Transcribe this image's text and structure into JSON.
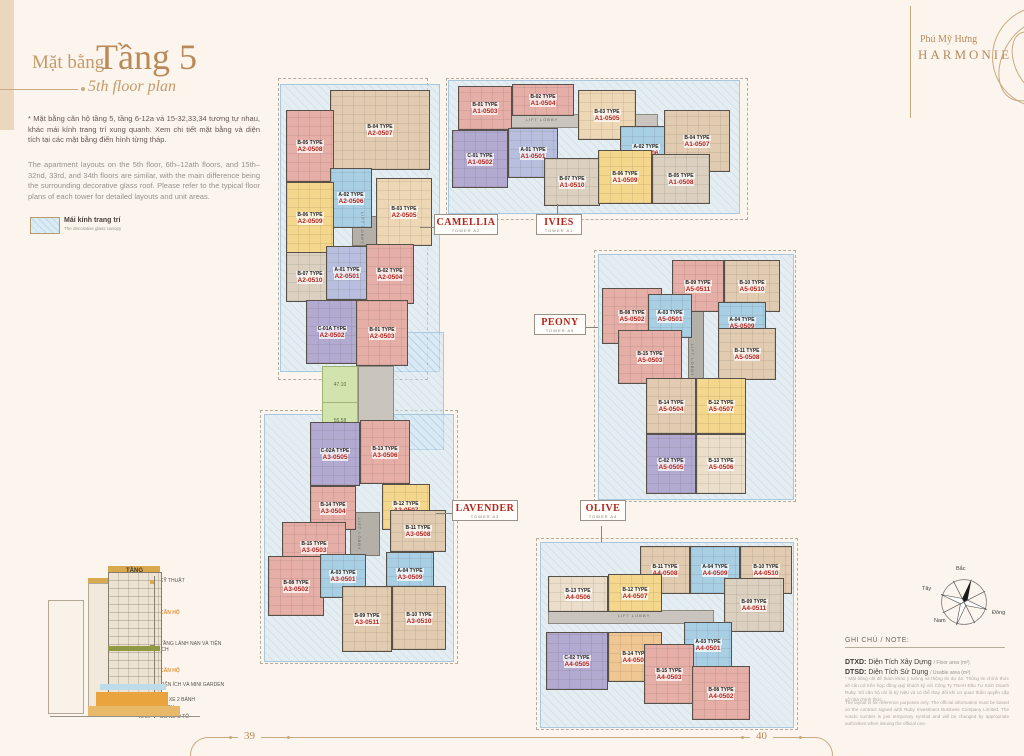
{
  "brand": {
    "line1": "Phú Mỹ Hưng",
    "line2": "HARMONIE"
  },
  "title": {
    "prefix": "Mặt bằng",
    "main": "Tầng 5",
    "sub": "5th floor plan"
  },
  "intro": {
    "vi": "* Mặt bằng căn hộ tầng 5, tầng 6-12a và 15-32,33,34 tương tự nhau, khác mái kính trang trí xung quanh. Xem chi tiết mặt bằng và diện tích tại các mặt bằng điển hình từng tháp.",
    "en": "The apartment layouts on the 5th floor, 6th–12ath floors, and 15th–32nd, 33rd, and 34th floors are similar, with the main difference being the surrounding decorative glass roof. Please refer to the typical floor plans of each tower for detailed layouts and unit areas."
  },
  "legend": {
    "vi": "Mái kính trang trí",
    "en": "The decorative glass canopy"
  },
  "plan": {
    "lift_lobby": "LIFT LOBBY",
    "green_areas": [
      "47.10",
      "55.58"
    ]
  },
  "towers": [
    {
      "name": "CAMELLIA",
      "tower": "TOWER A2",
      "units": [
        {
          "type": "B-04 TYPE",
          "code": "A2-0507",
          "color": "#e1cbb1"
        },
        {
          "type": "B-05 TYPE",
          "code": "A2-0508",
          "color": "#e5afa7"
        },
        {
          "type": "A-02 TYPE",
          "code": "A2-0506",
          "color": "#a8cfe4"
        },
        {
          "type": "B-06 TYPE",
          "code": "A2-0509",
          "color": "#f4d78c"
        },
        {
          "type": "B-03 TYPE",
          "code": "A2-0505",
          "color": "#edd7b5"
        },
        {
          "type": "B-07 TYPE",
          "code": "A2-0510",
          "color": "#dcd1c1"
        },
        {
          "type": "A-01 TYPE",
          "code": "A2-0501",
          "color": "#b8bede"
        },
        {
          "type": "B-02 TYPE",
          "code": "A2-0504",
          "color": "#e5afa7"
        },
        {
          "type": "C-01A TYPE",
          "code": "A2-0502",
          "color": "#b2aad1"
        },
        {
          "type": "B-01 TYPE",
          "code": "A2-0503",
          "color": "#e5afa7"
        }
      ]
    },
    {
      "name": "IVIES",
      "tower": "TOWER A1",
      "units": [
        {
          "type": "B-01 TYPE",
          "code": "A1-0503",
          "color": "#e5afa7"
        },
        {
          "type": "B-02 TYPE",
          "code": "A1-0504",
          "color": "#e5afa7"
        },
        {
          "type": "B-03 TYPE",
          "code": "A1-0505",
          "color": "#edd7b5"
        },
        {
          "type": "C-01 TYPE",
          "code": "A1-0502",
          "color": "#b2aad1"
        },
        {
          "type": "A-01 TYPE",
          "code": "A1-0501",
          "color": "#b8bede"
        },
        {
          "type": "A-02 TYPE",
          "code": "A1-0506",
          "color": "#a8cfe4"
        },
        {
          "type": "B-04 TYPE",
          "code": "A1-0507",
          "color": "#e1cbb1"
        },
        {
          "type": "B-07 TYPE",
          "code": "A1-0510",
          "color": "#dcd1c1"
        },
        {
          "type": "B-06 TYPE",
          "code": "A1-0509",
          "color": "#f4d78c"
        },
        {
          "type": "B-05 TYPE",
          "code": "A1-0508",
          "color": "#dcd1c1"
        }
      ]
    },
    {
      "name": "PEONY",
      "tower": "TOWER A5",
      "units": [
        {
          "type": "B-09 TYPE",
          "code": "A5-0511",
          "color": "#e5afa7"
        },
        {
          "type": "B-10 TYPE",
          "code": "A5-0510",
          "color": "#e1cbb1"
        },
        {
          "type": "B-08 TYPE",
          "code": "A5-0502",
          "color": "#e5afa7"
        },
        {
          "type": "A-03 TYPE",
          "code": "A5-0501",
          "color": "#a8cfe4"
        },
        {
          "type": "A-04 TYPE",
          "code": "A5-0509",
          "color": "#a8cfe4"
        },
        {
          "type": "B-15 TYPE",
          "code": "A5-0503",
          "color": "#e5afa7"
        },
        {
          "type": "B-11 TYPE",
          "code": "A5-0508",
          "color": "#e1cbb1"
        },
        {
          "type": "B-14 TYPE",
          "code": "A5-0504",
          "color": "#e1cbb1"
        },
        {
          "type": "B-12 TYPE",
          "code": "A5-0507",
          "color": "#f4d78c"
        },
        {
          "type": "C-02 TYPE",
          "code": "A5-0505",
          "color": "#b2aad1"
        },
        {
          "type": "B-13 TYPE",
          "code": "A5-0506",
          "color": "#ebdfcb"
        }
      ]
    },
    {
      "name": "LAVENDER",
      "tower": "TOWER A3",
      "units": [
        {
          "type": "C-02A TYPE",
          "code": "A3-0505",
          "color": "#b2aad1"
        },
        {
          "type": "B-13 TYPE",
          "code": "A3-0506",
          "color": "#e5afa7"
        },
        {
          "type": "B-14 TYPE",
          "code": "A3-0504",
          "color": "#e5afa7"
        },
        {
          "type": "B-12 TYPE",
          "code": "A3-0507",
          "color": "#f4d78c"
        },
        {
          "type": "B-15 TYPE",
          "code": "A3-0503",
          "color": "#e5afa7"
        },
        {
          "type": "B-11 TYPE",
          "code": "A3-0508",
          "color": "#e1cbb1"
        },
        {
          "type": "B-08 TYPE",
          "code": "A3-0502",
          "color": "#e5afa7"
        },
        {
          "type": "A-03 TYPE",
          "code": "A3-0501",
          "color": "#a8cfe4"
        },
        {
          "type": "A-04 TYPE",
          "code": "A3-0509",
          "color": "#a8cfe4"
        },
        {
          "type": "B-09 TYPE",
          "code": "A3-0511",
          "color": "#e1cbb1"
        },
        {
          "type": "B-10 TYPE",
          "code": "A3-0510",
          "color": "#e1cbb1"
        }
      ]
    },
    {
      "name": "OLIVE",
      "tower": "TOWER A4",
      "units": [
        {
          "type": "B-11 TYPE",
          "code": "A4-0508",
          "color": "#e1cbb1"
        },
        {
          "type": "A-04 TYPE",
          "code": "A4-0509",
          "color": "#a8cfe4"
        },
        {
          "type": "B-10 TYPE",
          "code": "A4-0510",
          "color": "#e1cbb1"
        },
        {
          "type": "B-13 TYPE",
          "code": "A4-0506",
          "color": "#ebdfcb"
        },
        {
          "type": "B-12 TYPE",
          "code": "A4-0507",
          "color": "#f4d78c"
        },
        {
          "type": "B-09 TYPE",
          "code": "A4-0511",
          "color": "#dcd1c1"
        },
        {
          "type": "C-02 TYPE",
          "code": "A4-0505",
          "color": "#b2aad1"
        },
        {
          "type": "B-14 TYPE",
          "code": "A4-0504",
          "color": "#f0c693"
        },
        {
          "type": "A-03 TYPE",
          "code": "A4-0501",
          "color": "#a8cfe4"
        },
        {
          "type": "B-15 TYPE",
          "code": "A4-0503",
          "color": "#e5afa7"
        },
        {
          "type": "B-08 TYPE",
          "code": "A4-0502",
          "color": "#e5afa7"
        }
      ]
    }
  ],
  "elevation": {
    "header": "TẦNG",
    "floors": [
      {
        "range": "",
        "label": "KỸ THUẬT"
      },
      {
        "range": "15-34F",
        "label": "CĂN HỘ"
      },
      {
        "range": "14F",
        "label": "TẦNG LÁNH NẠN VÀ TIỆN ÍCH"
      },
      {
        "range": "5-12AF",
        "label": "CĂN HỘ"
      },
      {
        "range": "4F",
        "label": "TIỆN ÍCH VÀ MINI GARDEN"
      },
      {
        "range": "3F",
        "label": "ĐỖ XE 2 BÁNH"
      },
      {
        "range": "1-2F",
        "label": "TMDV"
      },
      {
        "range": "HẦM",
        "label": "ĐỖ XE Ô TÔ"
      }
    ]
  },
  "compass": {
    "n": "Bắc",
    "s": "Nam",
    "e": "Đông",
    "w": "Tây"
  },
  "notes": {
    "header": "GHI CHÚ / NOTE:",
    "dtxd_abbr": "DTXD:",
    "dtxd_vi": "Diện Tích Xây Dựng",
    "dtxd_en": "/ Floor area (m²)",
    "dtsd_abbr": "DTSD:",
    "dtsd_vi": "Diện Tích Sử Dụng",
    "dtsd_en": "/ Usable area (m²)",
    "disclaimer_vi": "* Mặt bằng chỉ để tham khảo ý tưởng và thông tin dự án. Thông tin chính thức sẽ căn cứ trên hợp đồng quý khách ký với Công Ty TNHH Đầu Tư Kinh Doanh Ruby. Số căn hộ chỉ là ký hiệu và có thể thay đổi khi cơ quan thẩm quyền cấp số nhà chính thức.",
    "disclaimer_en": "The layout is for reference purposes only. The official information must be based on the contract signed with Ruby Investment Business Company Limited. The condo number is just temporary symbol and will be changed by appropriate authorities when issuing the official one."
  },
  "page": {
    "left_number": "39",
    "right_number": "40"
  }
}
